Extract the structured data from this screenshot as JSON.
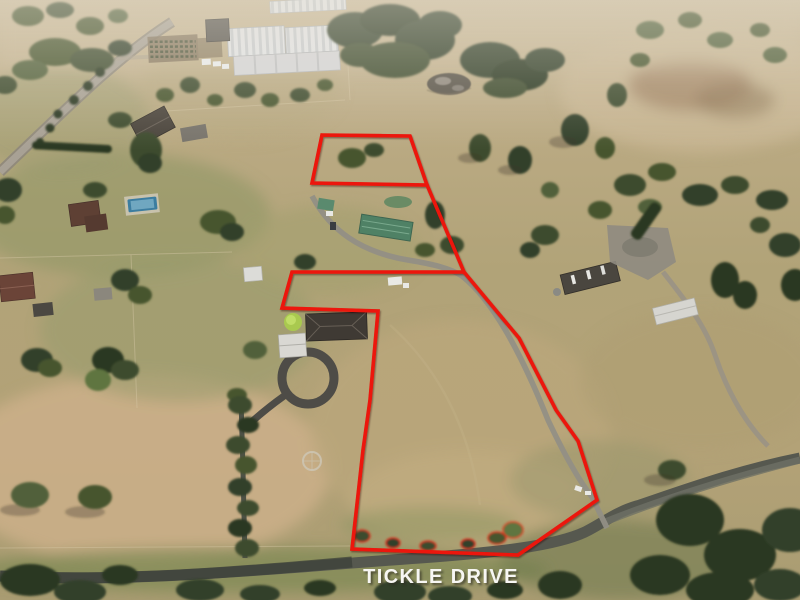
{
  "overlay": {
    "road_label": "TICKLE DRIVE",
    "boundary_color": "#ec1408",
    "label_color": "#f7f6f3",
    "lots": {
      "top_lot_points": "322,135 410,136 427,185 312,183",
      "connector_points": "427,185 464,272",
      "main_lot_points": "464,272 292,272 282,308 378,311 370,400 363,450 352,549 518,555 597,500 578,441 556,410 519,338"
    }
  },
  "palette": {
    "grass_tan": "#b5a478",
    "grass_green": "#8f9466",
    "tree_dark_green": "#33412a",
    "road_asphalt": "#56584f",
    "driveway_gray": "#928f85",
    "greenhouse_white": "#e3e4e6",
    "green_roof_teal": "#4f8165",
    "pool_blue": "#3c7da0",
    "roof_charcoal": "#3f3a34",
    "roof_rust": "#5e4034"
  }
}
